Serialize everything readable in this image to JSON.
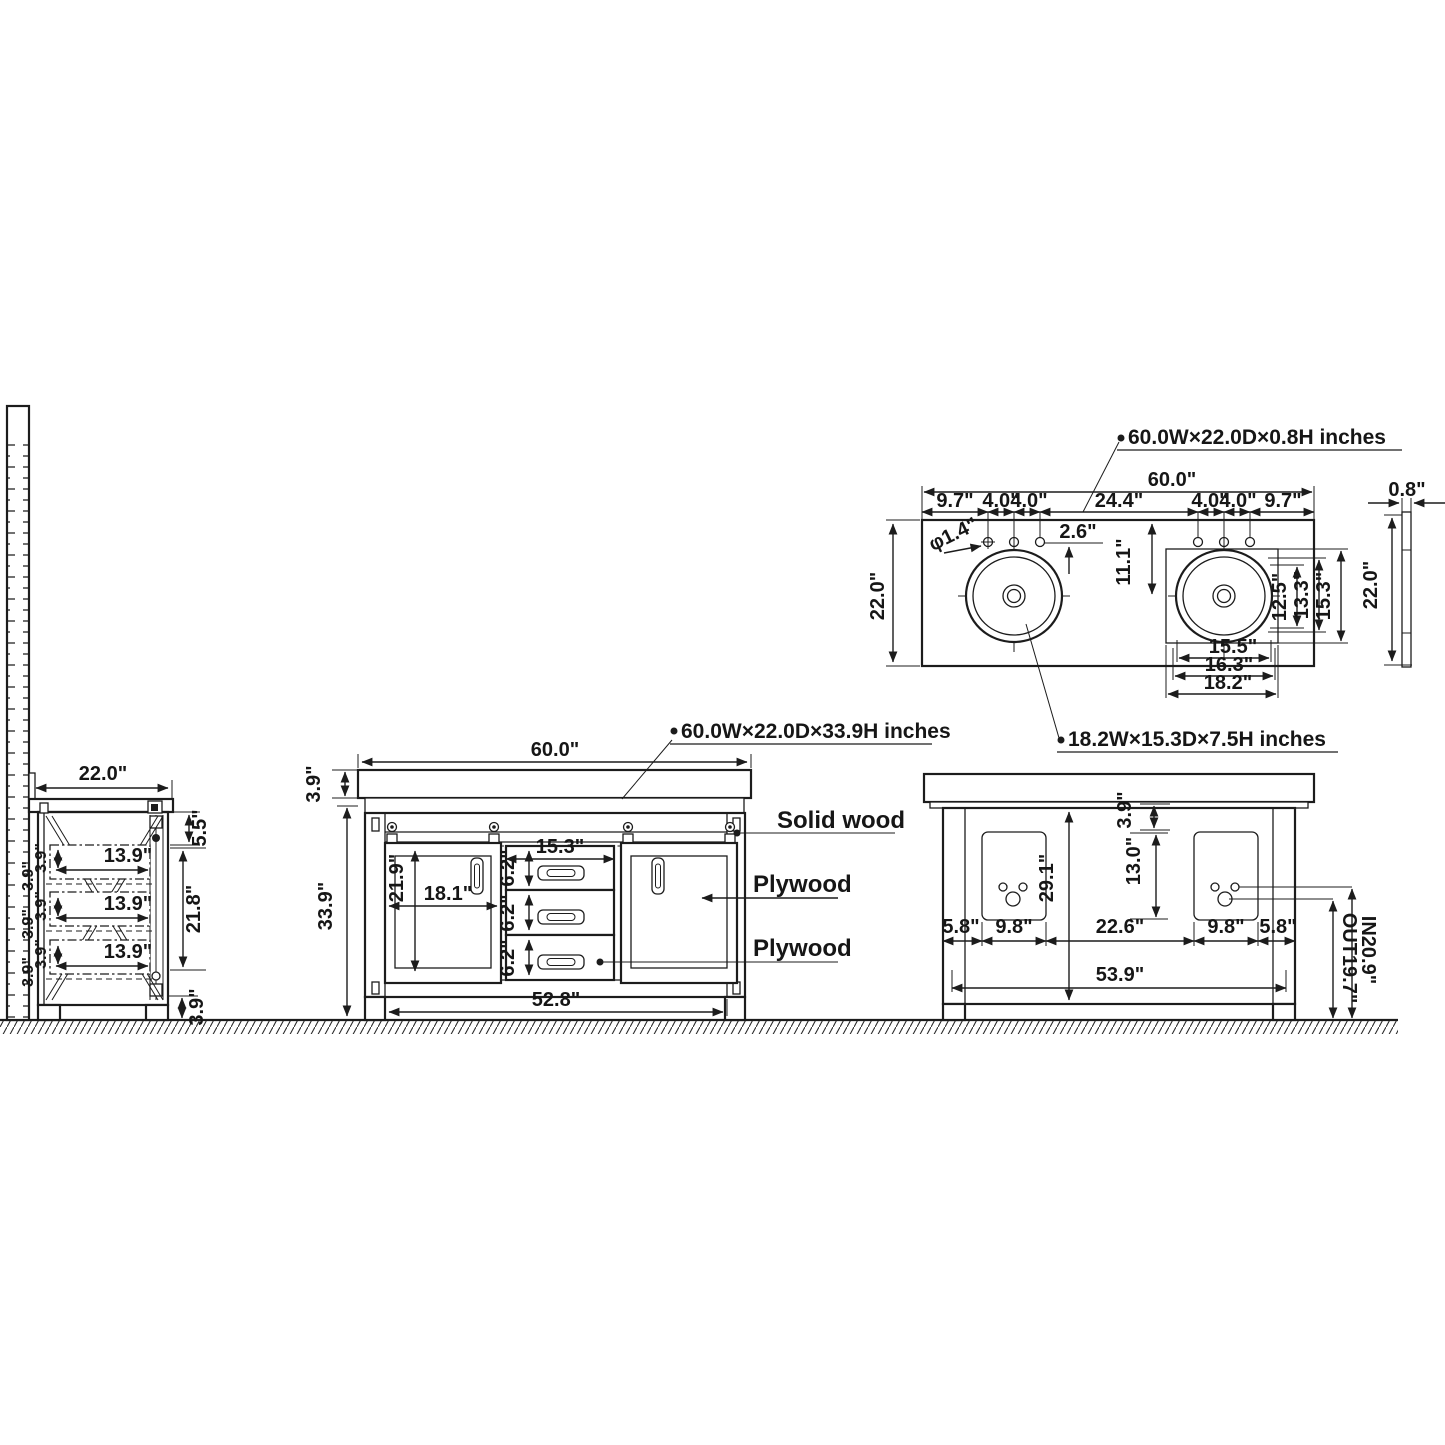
{
  "drawing": {
    "type": "technical-drawing",
    "subject": "60 inch double-sink bathroom vanity dimension diagram",
    "line_color": "#1c1c1c",
    "background": "#ffffff"
  },
  "side": {
    "width_label": "22.0\"",
    "gap_label": "5.5\"",
    "opening_label": "21.8\"",
    "toe_label": "3.9\"",
    "drawer_depth_labels": [
      "13.9\"",
      "13.9\"",
      "13.9\""
    ],
    "drawer_height_labels": [
      "3.9\"",
      "3.9\"",
      "3.9\"",
      "3.9\"",
      "3.9\"",
      "3.9\""
    ]
  },
  "front": {
    "title": "60.0W×22.0D×33.9H inches",
    "width_label": "60.0\"",
    "counter_thickness_label": "3.9\"",
    "height_label": "33.9\"",
    "door_width_label": "18.1\"",
    "door_height_label": "21.9\"",
    "drawer_width_label": "15.3\"",
    "drawer_height_labels": [
      "6.2\"",
      "6.2\"",
      "6.2\""
    ],
    "base_width_label": "52.8\"",
    "materials": [
      "Solid wood",
      "Plywood",
      "Plywood"
    ]
  },
  "top": {
    "title": "60.0W×22.0D×0.8H inches",
    "sink_label": "18.2W×15.3D×7.5H inches",
    "width_label": "60.0\"",
    "spacing_labels": [
      "9.7\"",
      "4.0\"",
      "4.0\"",
      "24.4\"",
      "4.0\"",
      "4.0\"",
      "9.7\""
    ],
    "hole_dia_label": "φ1.4\"",
    "offset_label": "2.6\"",
    "sink_center_label": "11.1\"",
    "depth_label": "22.0\"",
    "sink_v_labels": [
      "12.5\"",
      "13.3\"",
      "15.3\""
    ],
    "sink_h_labels": [
      "15.5\"",
      "16.3\"",
      "18.2\""
    ],
    "edge_thickness_label": "0.8\"",
    "edge_depth_label": "22.0\""
  },
  "back": {
    "counter_thickness_label": "3.9\"",
    "opening_height_label": "29.1\"",
    "cutout_height_label": "13.0\"",
    "bottom_labels": [
      "5.8\"",
      "9.8\"",
      "22.6\"",
      "9.8\"",
      "5.8\""
    ],
    "inner_width_label": "53.9\"",
    "inlet_label": "IN20.9\"",
    "outlet_label": "OUT19.7\""
  }
}
